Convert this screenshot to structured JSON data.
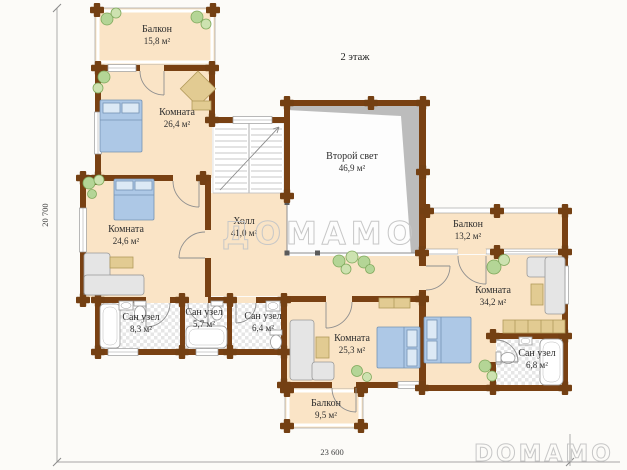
{
  "title": "2 этаж",
  "dimensions": {
    "vertical": "20 700",
    "horizontal": "23 600"
  },
  "watermarks": {
    "center": "ДОМАМО",
    "corner": "DOMAMO"
  },
  "rooms": [
    {
      "name": "Балкон",
      "area": "15,8 м²"
    },
    {
      "name": "Комната",
      "area": "26,4 м²"
    },
    {
      "name": "Комната",
      "area": "24,6 м²"
    },
    {
      "name": "Холл",
      "area": "41,0 м²"
    },
    {
      "name": "Второй свет",
      "area": "46,9 м²"
    },
    {
      "name": "Балкон",
      "area": "13,2 м²"
    },
    {
      "name": "Комната",
      "area": "34,2 м²"
    },
    {
      "name": "Сан узел",
      "area": "8,3 м²"
    },
    {
      "name": "Сан узел",
      "area": "5,7 м²"
    },
    {
      "name": "Сан узел",
      "area": "6,4 м²"
    },
    {
      "name": "Комната",
      "area": "25,3 м²"
    },
    {
      "name": "Сан узел",
      "area": "6,8 м²"
    },
    {
      "name": "Балкон",
      "area": "9,5 м²"
    }
  ],
  "colors": {
    "wall": "#794113",
    "floor": "#fae4c6",
    "bed": "#adc8e6",
    "plant": "#b4d596",
    "sofa": "#e5e5e5",
    "table": "#e2cb92",
    "void_shading": "#bcbcbc"
  }
}
